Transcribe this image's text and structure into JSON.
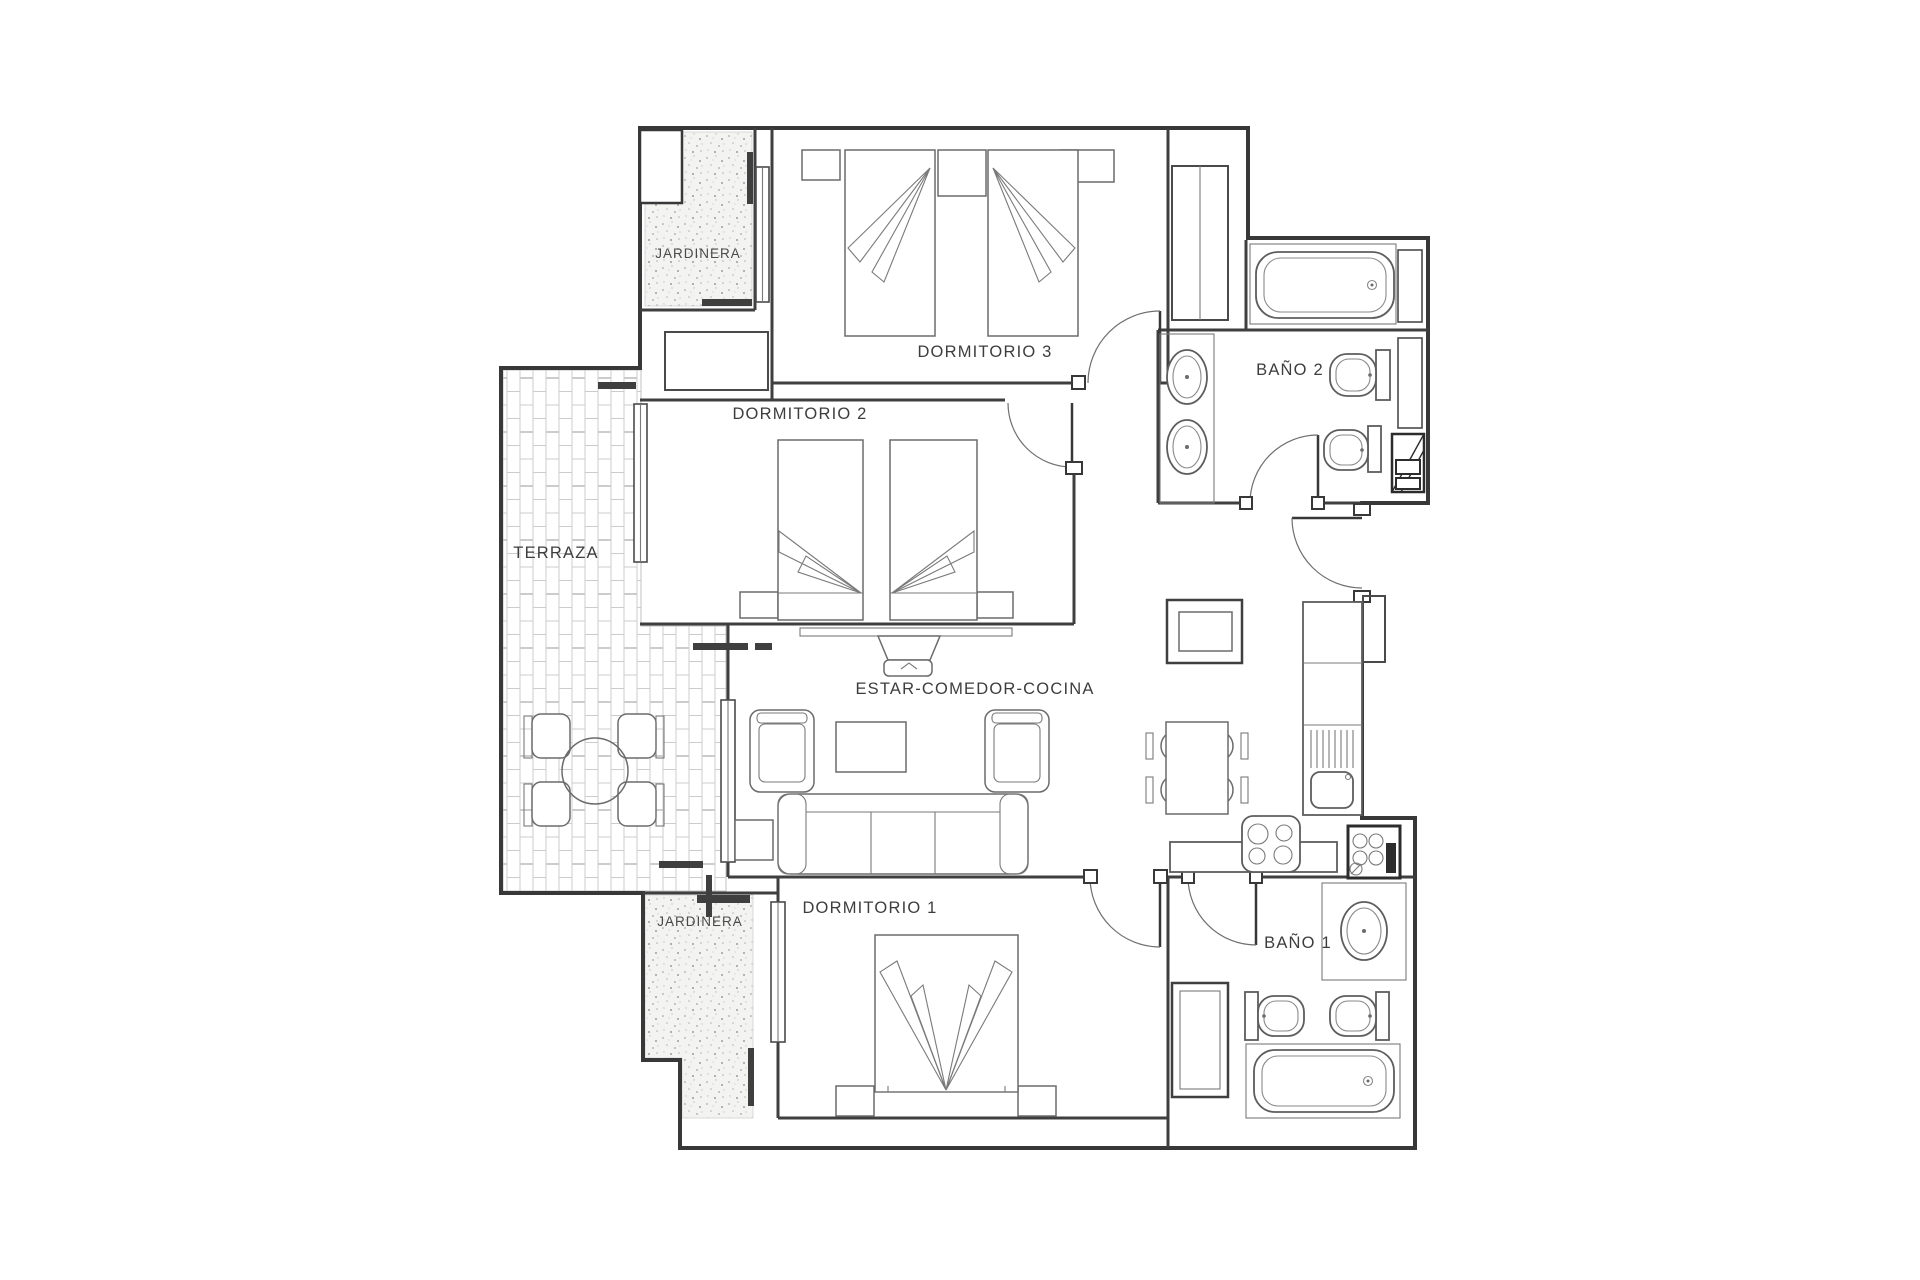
{
  "floor_plan": {
    "type": "apartment-floor-plan",
    "palette": {
      "background": "#ffffff",
      "wall": "#383838",
      "furniture": "#6b6b6b",
      "tile_lines": "#cccccc",
      "speckle": "#a8a8a8",
      "label": "#3d3d3d"
    },
    "rooms": {
      "jardinera_top": "JARDINERA",
      "dormitorio_3": "DORMITORIO 3",
      "dormitorio_2": "DORMITORIO 2",
      "bano_2": "BAÑO 2",
      "terraza": "TERRAZA",
      "estar_comedor_cocina": "ESTAR-COMEDOR-COCINA",
      "jardinera_bottom": "JARDINERA",
      "dormitorio_1": "DORMITORIO 1",
      "bano_1": "BAÑO 1"
    }
  }
}
